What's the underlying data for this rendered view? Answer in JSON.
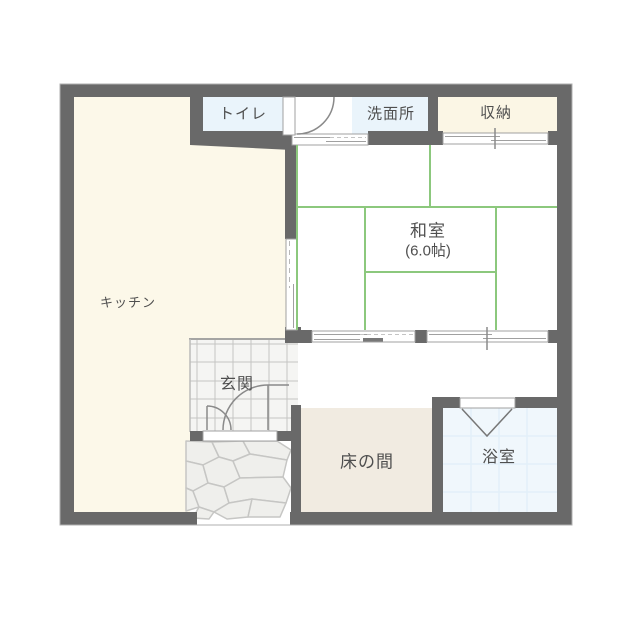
{
  "floor_plan": {
    "rooms": {
      "toilet": {
        "label": "トイレ"
      },
      "washroom": {
        "label": "洗面所"
      },
      "storage": {
        "label": "収納"
      },
      "kitchen": {
        "label": "キッチン"
      },
      "japanese_room": {
        "label": "和室",
        "size": "(6.0帖)"
      },
      "entrance": {
        "label": "玄関"
      },
      "tokonoma": {
        "label": "床の間"
      },
      "bathroom": {
        "label": "浴室"
      }
    },
    "colors": {
      "wall": "#696969",
      "kitchen_fill": "#FCF8E9",
      "toilet_washroom_fill": "#EAF4FB",
      "storage_fill": "#FBF6E5",
      "tokonoma_fill": "#F1EBE1",
      "bathroom_fill": "#F0F7FC",
      "tatami_line": "#8CC87D",
      "entrance_tile_fill": "#F5F5F3",
      "stone_fill": "#EFEFEC",
      "label_text": "#4F4F4F"
    }
  }
}
